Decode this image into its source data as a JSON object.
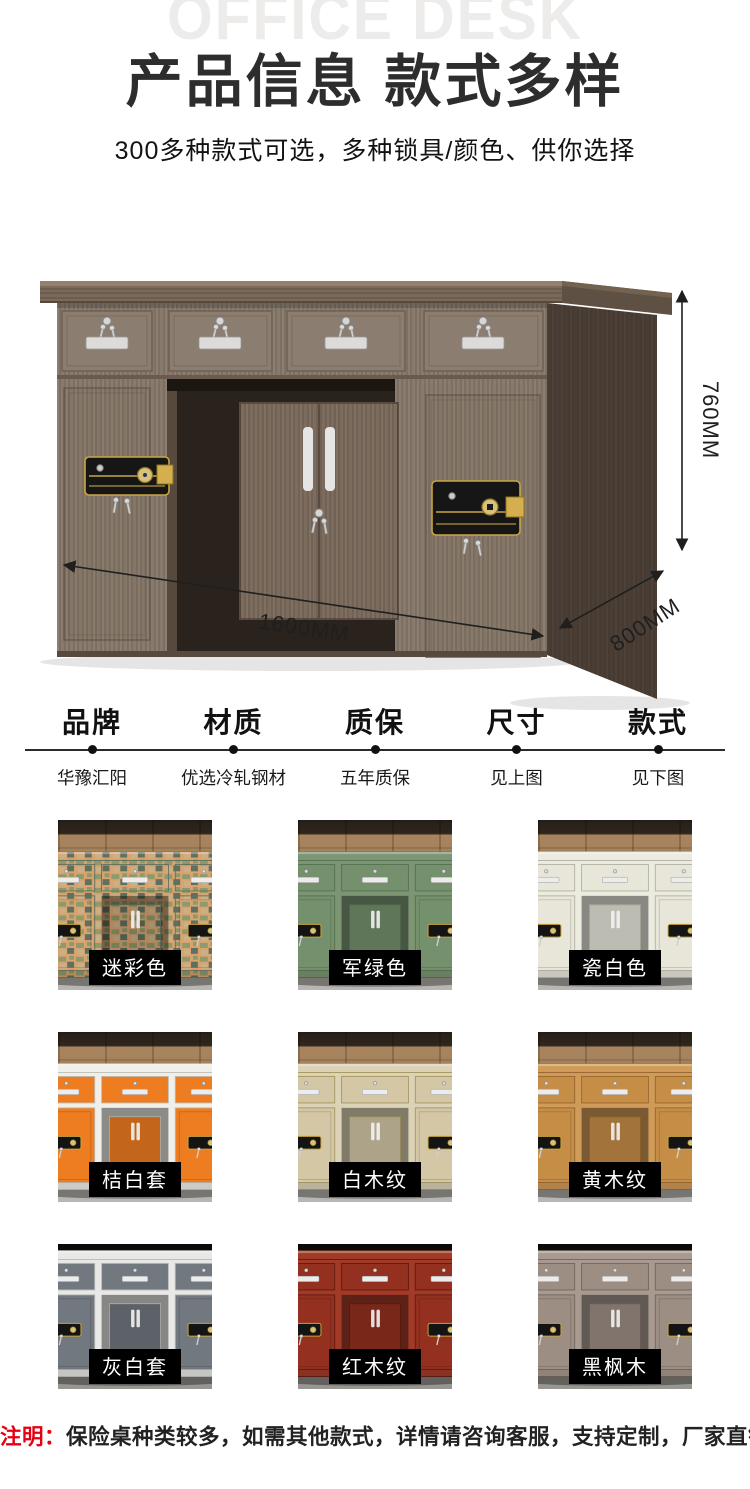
{
  "watermark": "OFFICE DESK",
  "header": {
    "title": "产品信息 款式多样",
    "subtitle": "300多种款式可选，多种锁具/颜色、供你选择"
  },
  "hero": {
    "dimensions": {
      "height": "760MM",
      "width": "1600MM",
      "depth": "800MM"
    },
    "wood_color": "#887a6d",
    "side_color": "#493d34",
    "lock_gold": "#c9a544"
  },
  "specs": {
    "items": [
      {
        "label": "品牌",
        "value": "华豫汇阳"
      },
      {
        "label": "材质",
        "value": "优选冷轧钢材"
      },
      {
        "label": "质保",
        "value": "五年质保"
      },
      {
        "label": "尺寸",
        "value": "见上图"
      },
      {
        "label": "款式",
        "value": "见下图"
      }
    ]
  },
  "grid": {
    "items": [
      {
        "label": "迷彩色",
        "camo": true,
        "colors": {
          "frame": "#d9a36f",
          "panel": "#8d9a6b",
          "dark": "#5f6f5e"
        }
      },
      {
        "label": "军绿色",
        "camo": false,
        "colors": {
          "frame": "#7c9674",
          "panel": "#74906c",
          "dark": "#55704f"
        }
      },
      {
        "label": "瓷白色",
        "camo": false,
        "colors": {
          "frame": "#ecebe0",
          "panel": "#e7e6d9",
          "dark": "#b0af9f"
        }
      },
      {
        "label": "桔白套",
        "camo": false,
        "colors": {
          "frame": "#f0efe9",
          "panel": "#ee7d22",
          "dark": "#bdbcb4"
        }
      },
      {
        "label": "白木纹",
        "camo": false,
        "colors": {
          "frame": "#dcd2b6",
          "panel": "#d3c7a6",
          "dark": "#a3955e"
        }
      },
      {
        "label": "黄木纹",
        "camo": false,
        "colors": {
          "frame": "#d09b58",
          "panel": "#c68d47",
          "dark": "#95662e"
        }
      },
      {
        "label": "灰白套",
        "camo": false,
        "colors": {
          "frame": "#e8e8e6",
          "panel": "#72787f",
          "dark": "#b9b9b5"
        }
      },
      {
        "label": "红木纹",
        "camo": false,
        "colors": {
          "frame": "#a23a28",
          "panel": "#93301f",
          "dark": "#611a0e"
        }
      },
      {
        "label": "黑枫木",
        "camo": false,
        "colors": {
          "frame": "#a89a90",
          "panel": "#9d8e84",
          "dark": "#72645a"
        }
      }
    ]
  },
  "note": {
    "prefix": "注明：",
    "text": "保险桌种类较多，如需其他款式，详情请咨询客服，支持定制，厂家直销"
  },
  "accent_colors": {
    "note_red": "#e60012",
    "label_bg": "#000000",
    "label_text": "#ffffff"
  }
}
